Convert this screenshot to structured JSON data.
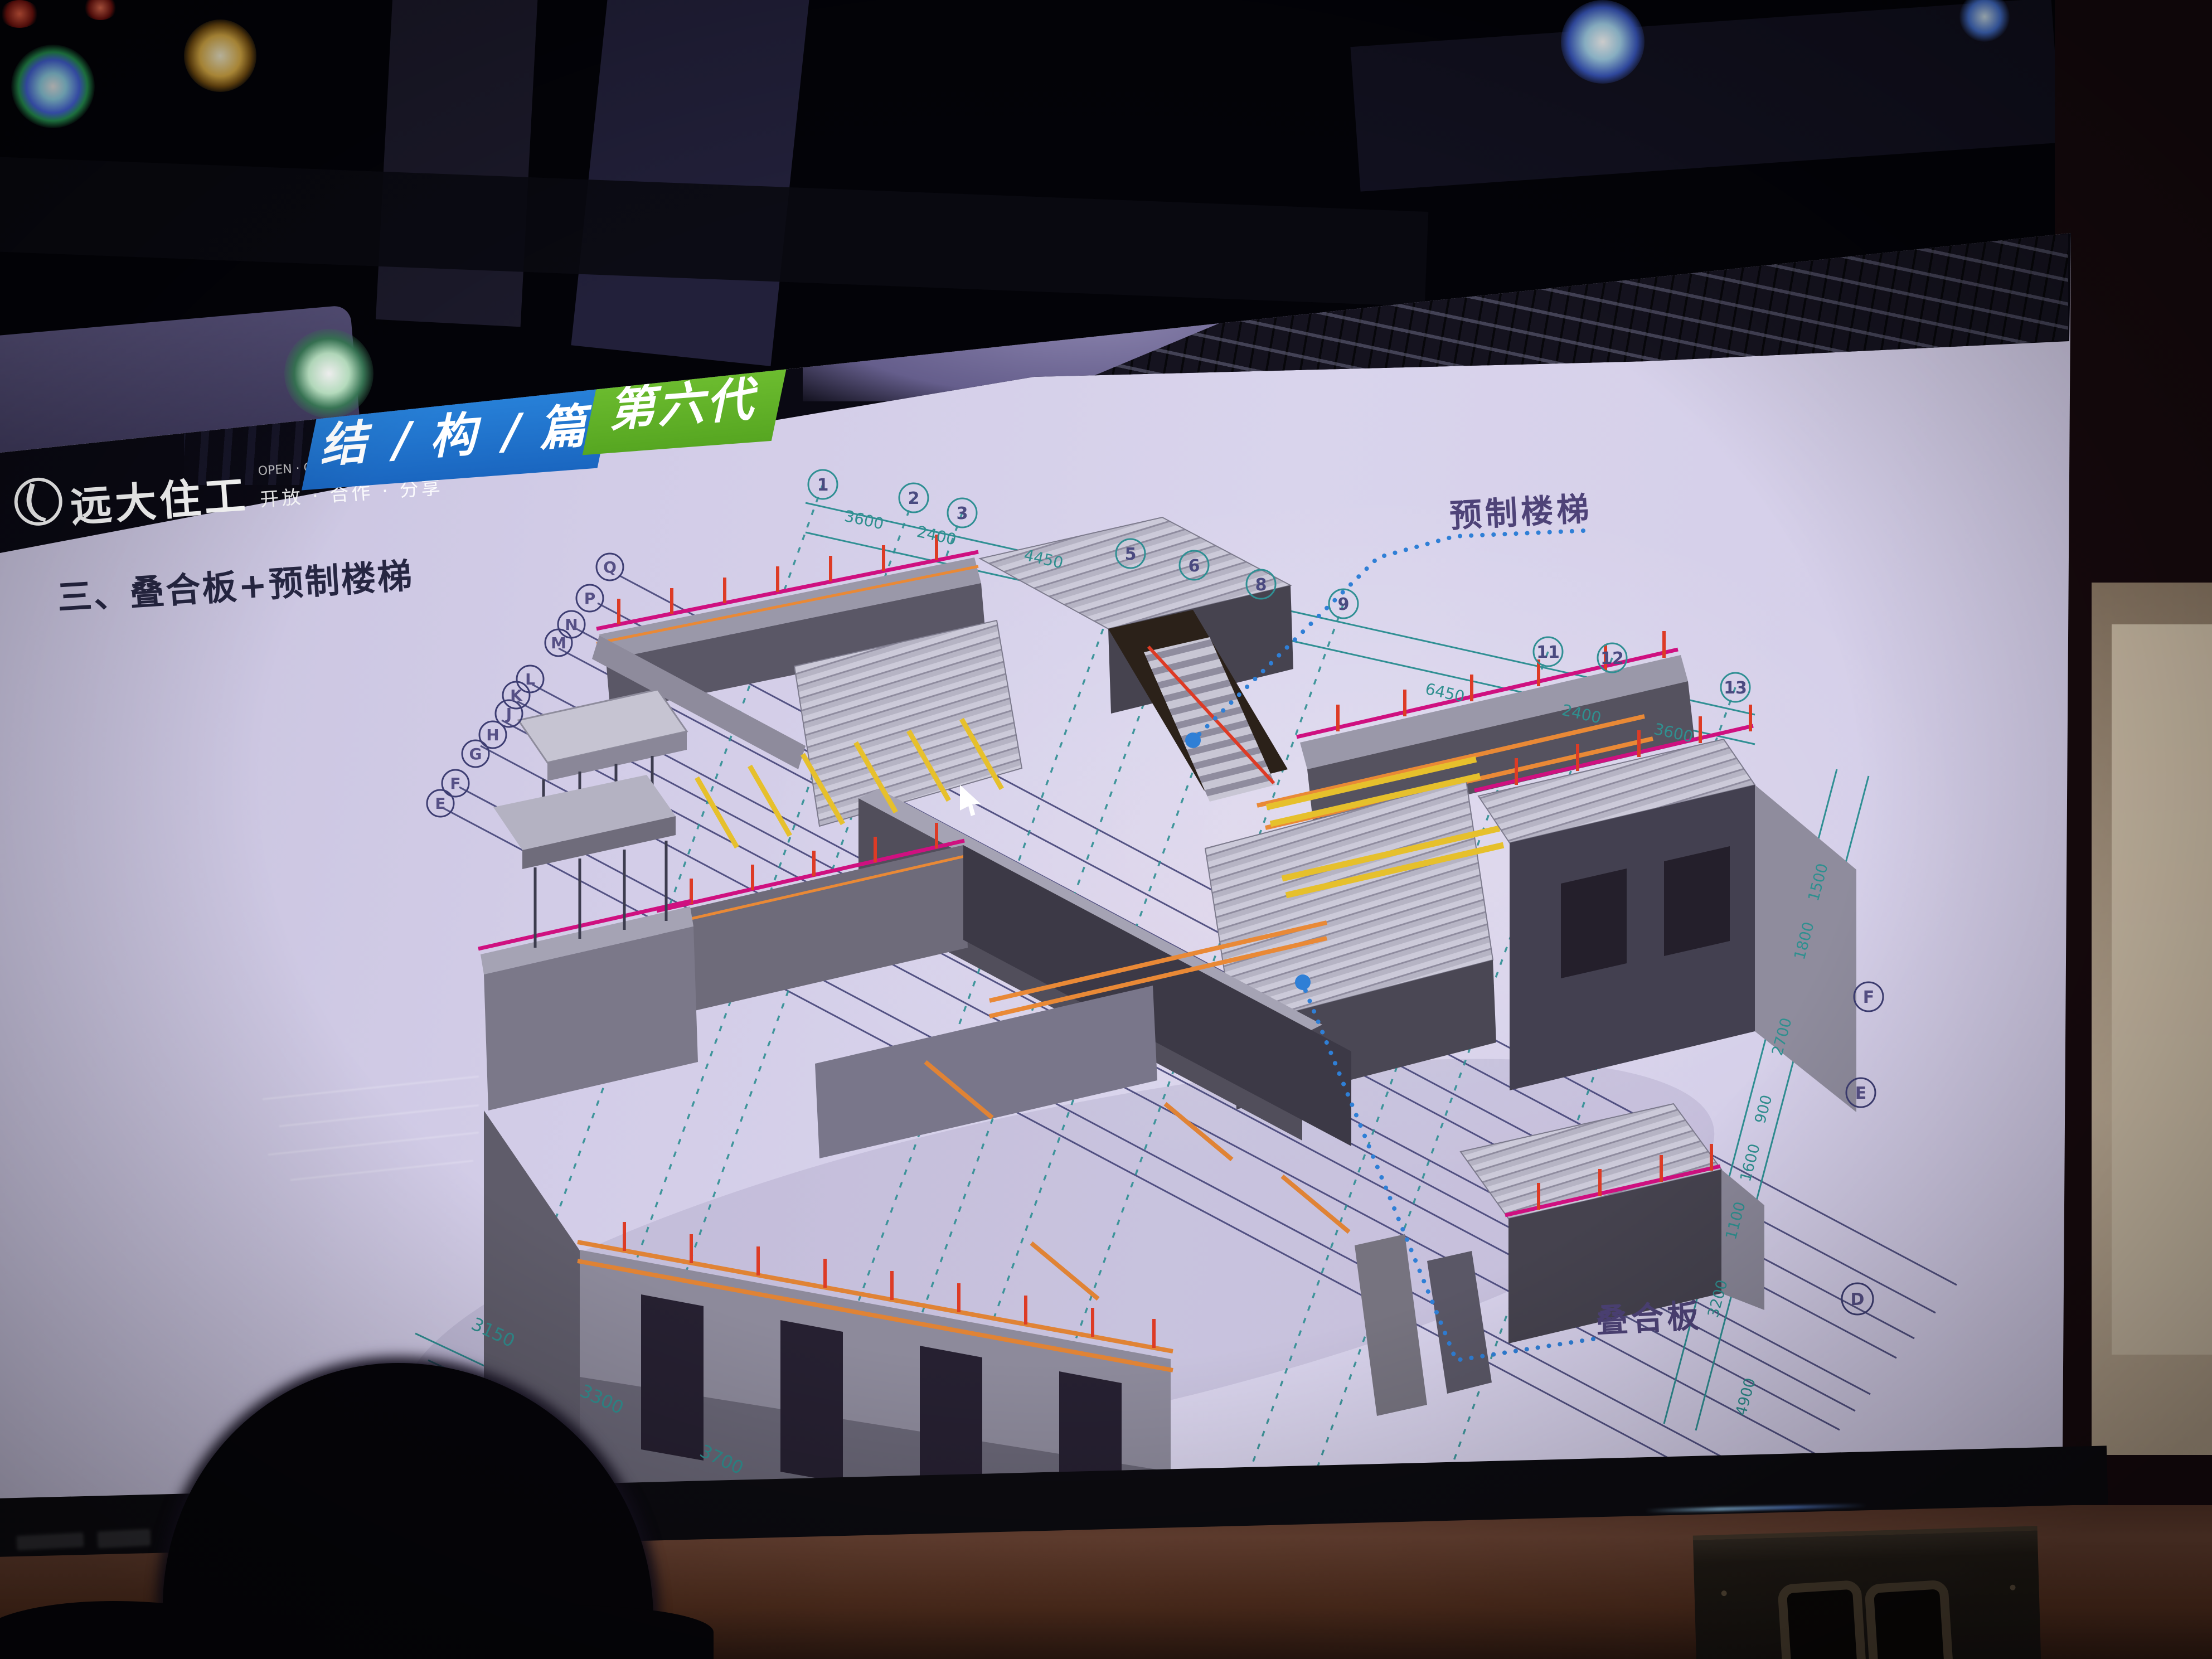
{
  "scene": {
    "description": "photo of a conference-room LED screen showing a BIM structure slide",
    "screen_bg": "#d3cde8"
  },
  "slide": {
    "logo": {
      "name": "远大住工",
      "tagline_cn": "开放 · 合作 · 分享",
      "tagline_en": "OPEN · COOPERATION · SHARE"
    },
    "banner_blue": "结 / 构 / 篇",
    "banner_green": "第六代",
    "title": "三、叠合板+预制楼梯",
    "annotation_stairs": "预制楼梯",
    "annotation_slab": "叠合板",
    "grid": {
      "top_bubbles": [
        "1",
        "2",
        "3",
        "5",
        "6",
        "8",
        "9",
        "11",
        "12",
        "13"
      ],
      "left_bubbles": [
        "Q",
        "P",
        "N",
        "M",
        "L",
        "K",
        "J",
        "H",
        "G",
        "F",
        "E"
      ],
      "right_bubbles": [
        "F",
        "E",
        "D"
      ],
      "dims_top": [
        "3600",
        "2400",
        "4450",
        "6450",
        "2400",
        "3600"
      ],
      "dims_right": [
        "1500",
        "1800",
        "2700",
        "900",
        "1600",
        "1100",
        "3200",
        "4900"
      ],
      "dims_bottom": [
        "3150",
        "3300",
        "3700"
      ]
    }
  },
  "colors": {
    "banner_blue": "#1d74cd",
    "banner_green": "#63b42c",
    "magenta_rail": "#cf1080",
    "red_post": "#dd3b25",
    "orange_rail": "#e98936",
    "yellow_prop": "#e6c02c",
    "teal_grid": "#2f8f93",
    "navy_grid": "#3d3d72",
    "leader_blue": "#2f7fd6",
    "annotation_text": "#4e4378",
    "title_text": "#262642"
  }
}
